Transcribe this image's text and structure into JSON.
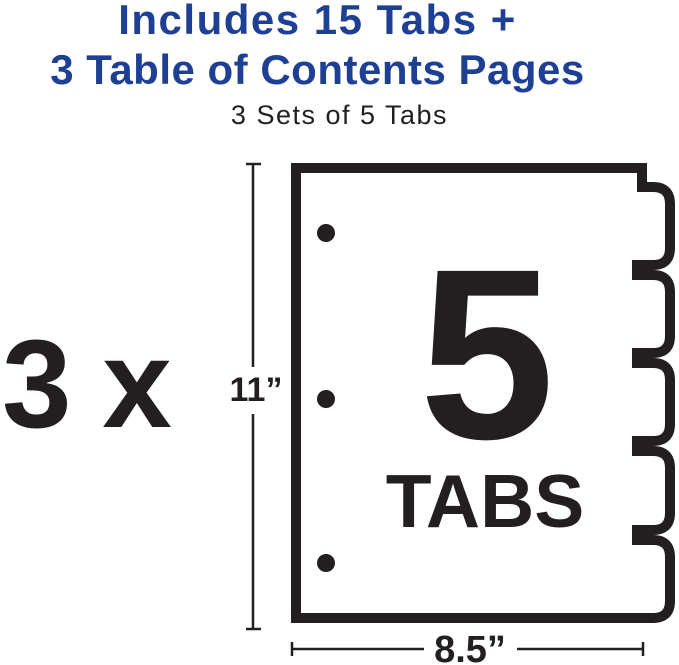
{
  "header": {
    "title_line1": "Includes 15 Tabs +",
    "title_line2": "3 Table of Contents Pages",
    "subtitle": "3 Sets of 5 Tabs",
    "title_color": "#1e4094"
  },
  "diagram": {
    "multiplier_label": "3 x",
    "height_label": "11”",
    "width_label": "8.5”",
    "tab_count_number": "5",
    "tab_count_caption": "TABS",
    "tabs_total": 5,
    "punch_holes_count": 3,
    "ink_color": "#231f20"
  }
}
